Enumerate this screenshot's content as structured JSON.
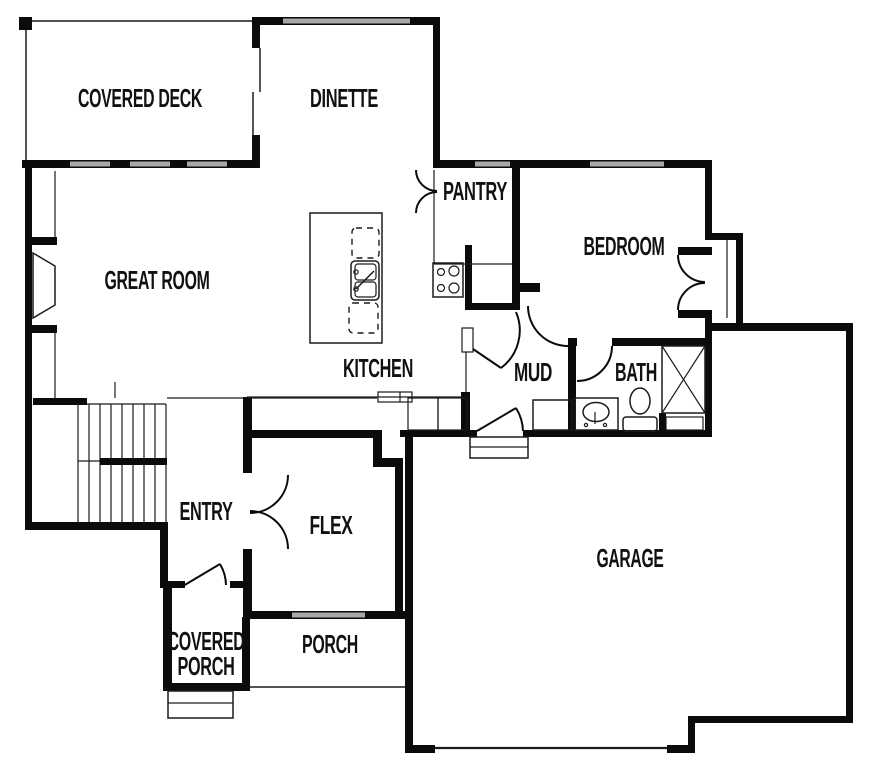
{
  "title": "First floor plan",
  "colors": {
    "background": "#ffffff",
    "wall": "#0b0b0b",
    "window": "#a8a8a8",
    "line": "#1c1c1c",
    "label": "#111111"
  },
  "rooms": {
    "covered_deck": {
      "label": "COVERED DECK"
    },
    "dinette": {
      "label": "DINETTE"
    },
    "pantry": {
      "label": "PANTRY"
    },
    "bedroom": {
      "label": "BEDROOM"
    },
    "great_room": {
      "label": "GREAT ROOM"
    },
    "kitchen": {
      "label": "KITCHEN"
    },
    "mud": {
      "label": "MUD"
    },
    "bath": {
      "label": "BATH"
    },
    "entry": {
      "label": "ENTRY"
    },
    "flex": {
      "label": "FLEX"
    },
    "garage": {
      "label": "GARAGE"
    },
    "covered_porch": {
      "label_line1": "COVERED",
      "label_line2": "PORCH"
    },
    "porch": {
      "label": "PORCH"
    }
  },
  "fixtures": [
    "stairs-icon",
    "fireplace-icon",
    "kitchen-island-icon",
    "island-sink-icon",
    "dishwasher-icon",
    "stove-cooktop-icon",
    "pantry-shelving-icon",
    "mud-bench-icon",
    "vanity-sink-icon",
    "toilet-icon",
    "linen-closet-icon",
    "bedroom-closet-icon",
    "garage-door-icon",
    "window-icon",
    "door-swing-icon",
    "entry-stoop-icon"
  ]
}
